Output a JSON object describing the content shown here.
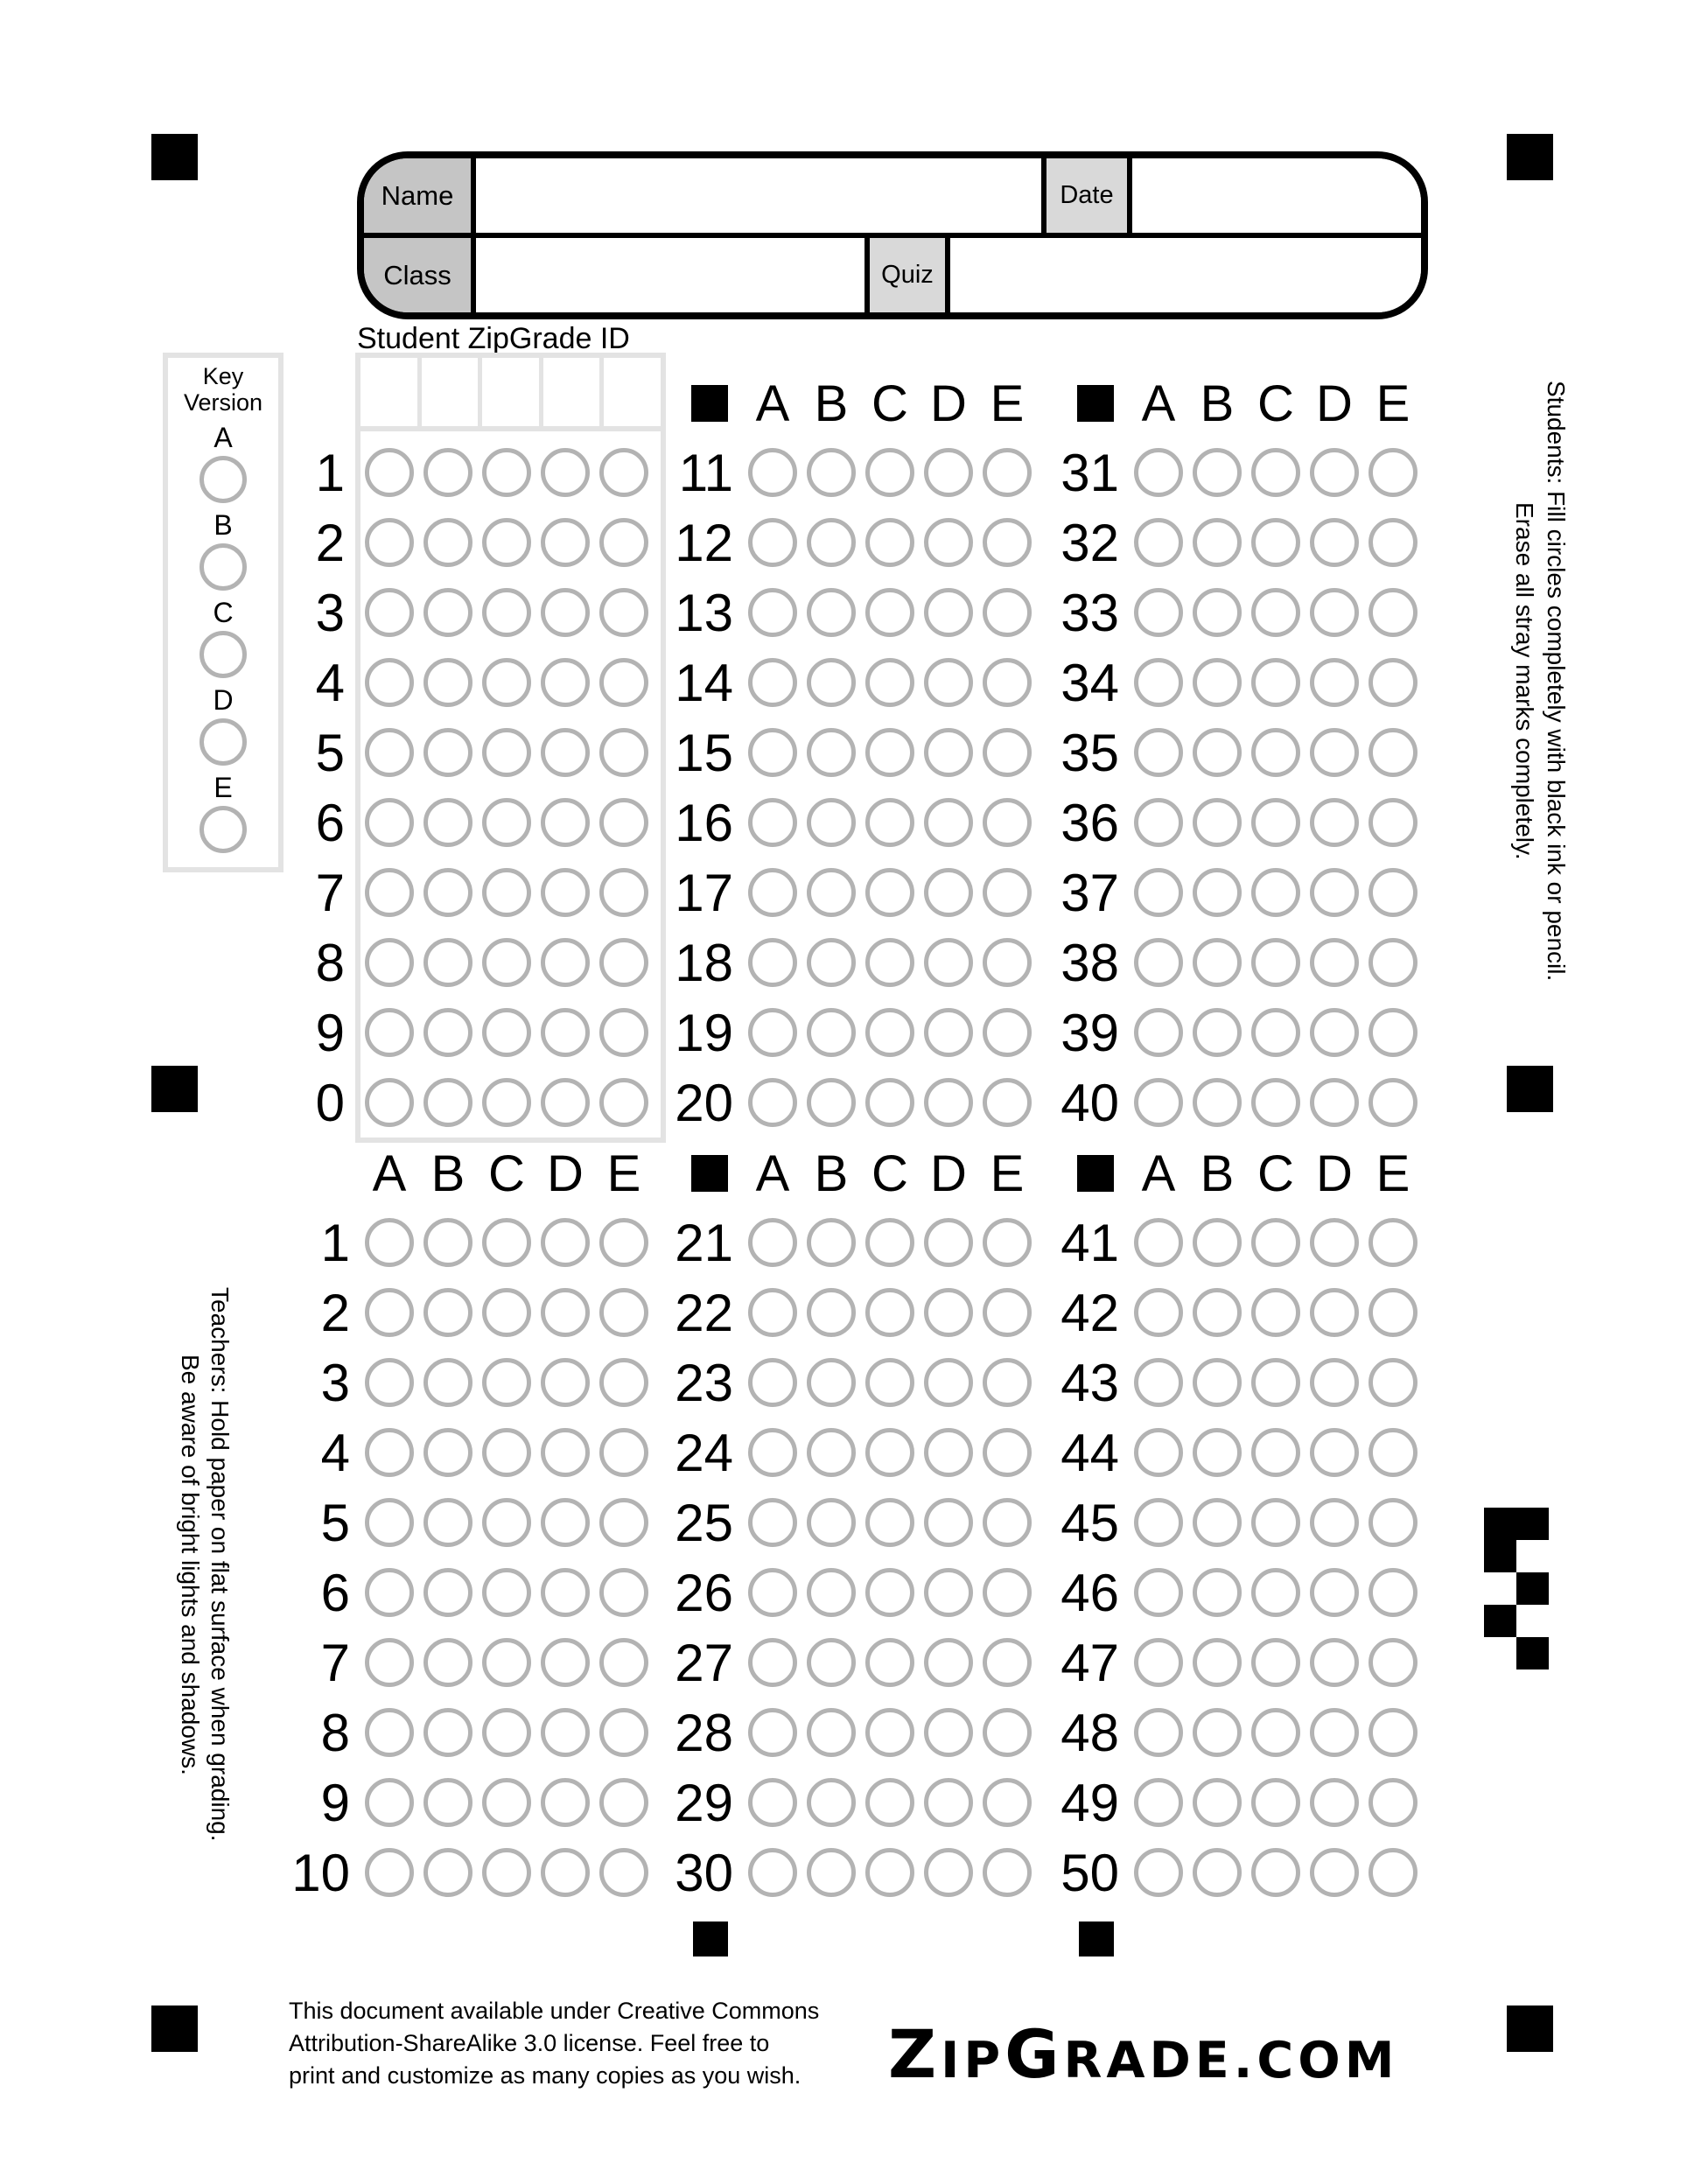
{
  "header": {
    "name_label": "Name",
    "date_label": "Date",
    "class_label": "Class",
    "quiz_label": "Quiz"
  },
  "student_id": {
    "title": "Student ZipGrade ID",
    "digit_rows": [
      "1",
      "2",
      "3",
      "4",
      "5",
      "6",
      "7",
      "8",
      "9",
      "0"
    ],
    "columns": 5
  },
  "key_version": {
    "title_line1": "Key",
    "title_line2": "Version",
    "options": [
      "A",
      "B",
      "C",
      "D",
      "E"
    ]
  },
  "answer_letters": [
    "A",
    "B",
    "C",
    "D",
    "E"
  ],
  "answer_blocks": [
    {
      "name": "questions-1-10",
      "numbers": [
        "1",
        "2",
        "3",
        "4",
        "5",
        "6",
        "7",
        "8",
        "9",
        "10"
      ],
      "header_square": false
    },
    {
      "name": "questions-11-20",
      "numbers": [
        "11",
        "12",
        "13",
        "14",
        "15",
        "16",
        "17",
        "18",
        "19",
        "20"
      ],
      "header_square": true
    },
    {
      "name": "questions-21-30",
      "numbers": [
        "21",
        "22",
        "23",
        "24",
        "25",
        "26",
        "27",
        "28",
        "29",
        "30"
      ],
      "header_square": true
    },
    {
      "name": "questions-31-40",
      "numbers": [
        "31",
        "32",
        "33",
        "34",
        "35",
        "36",
        "37",
        "38",
        "39",
        "40"
      ],
      "header_square": true
    },
    {
      "name": "questions-41-50",
      "numbers": [
        "41",
        "42",
        "43",
        "44",
        "45",
        "46",
        "47",
        "48",
        "49",
        "50"
      ],
      "header_square": true
    }
  ],
  "instructions": {
    "students_line1": "Students:  Fill circles completely with black ink or pencil.",
    "students_line2": "Erase all stray marks completely.",
    "teachers_line1": "Teachers: Hold paper on flat surface when grading.",
    "teachers_line2": "Be aware of bright lights and shadows."
  },
  "calibration": {
    "pattern": [
      "11",
      "10",
      "01",
      "10",
      "01"
    ]
  },
  "footer": {
    "license_lines": [
      "This document available under Creative Commons",
      "Attribution-ShareAlike 3.0 license.  Feel free to",
      "print and customize as many copies as you wish."
    ],
    "logo_parts": [
      {
        "text": "Z",
        "size": "lg"
      },
      {
        "text": "IP",
        "size": "sm"
      },
      {
        "text": "G",
        "size": "lg"
      },
      {
        "text": "RADE",
        "size": "sm"
      },
      {
        "text": ".",
        "size": "sm"
      },
      {
        "text": "COM",
        "size": "sm"
      }
    ]
  },
  "colors": {
    "bubble_stroke": "#b3b3b3",
    "grid_border": "#e3e3e3",
    "label_fill_dark": "#c5c5c5",
    "label_fill_light": "#d9d9d9",
    "mark_black": "#000000"
  }
}
